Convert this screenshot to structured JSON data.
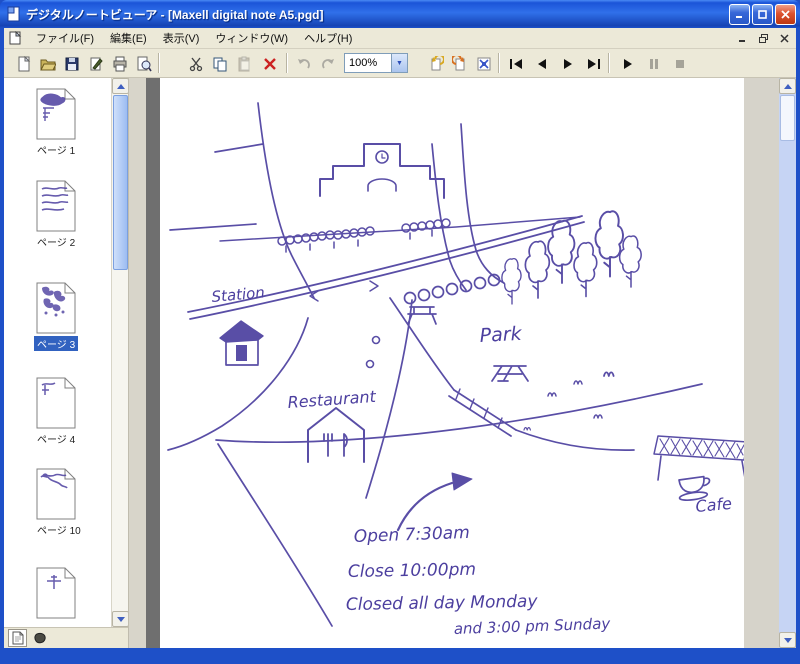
{
  "window": {
    "title": "デジタルノートビューア - [Maxell digital note A5.pgd]"
  },
  "menu": {
    "items": [
      "ファイル(F)",
      "編集(E)",
      "表示(V)",
      "ウィンドウ(W)",
      "ヘルプ(H)"
    ]
  },
  "toolbar": {
    "zoom_value": "100%",
    "icons": [
      "new",
      "open",
      "save",
      "import",
      "print",
      "print-preview",
      "cut",
      "copy",
      "paste",
      "delete",
      "undo",
      "redo",
      "zoom-select",
      "rotate-left",
      "rotate-right",
      "fit-page",
      "first-page",
      "prev-page",
      "next-page",
      "last-page",
      "play",
      "pause",
      "stop"
    ]
  },
  "sidebar": {
    "pages": [
      {
        "label": "ページ 1",
        "selected": false
      },
      {
        "label": "ページ 2",
        "selected": false
      },
      {
        "label": "ページ 3",
        "selected": true
      },
      {
        "label": "ページ 4",
        "selected": false
      },
      {
        "label": "ページ 10",
        "selected": false
      },
      {
        "label": "",
        "selected": false
      }
    ]
  },
  "map": {
    "labels": {
      "station": "Station",
      "park": "Park",
      "restaurant": "Restaurant",
      "cafe": "Cafe",
      "open_line": "Open 7:30am",
      "close_line": "Close 10:00pm",
      "closed_line1": "Closed all day Monday",
      "closed_line2": "and  3:00 pm Sunday"
    }
  },
  "colors": {
    "ink": "#4c3f9f",
    "titlebar": "#2f6ce8",
    "chrome": "#ece9d8",
    "selection": "#3162c0"
  }
}
